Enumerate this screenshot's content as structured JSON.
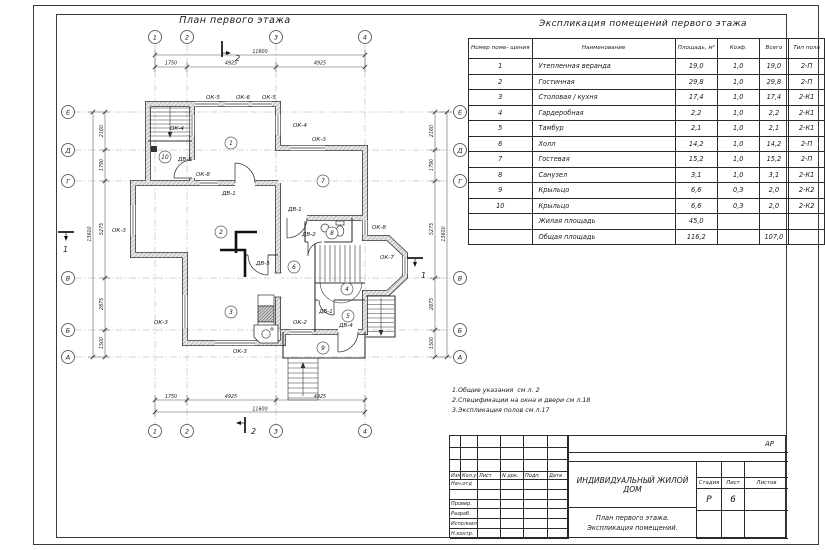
{
  "plan": {
    "title": "План первого этажа",
    "col_axes": [
      {
        "label": "1",
        "x": 105
      },
      {
        "label": "2",
        "x": 137
      },
      {
        "label": "3",
        "x": 226
      },
      {
        "label": "4",
        "x": 315
      }
    ],
    "row_axes": [
      {
        "label": "Е",
        "y": 102
      },
      {
        "label": "Д",
        "y": 140
      },
      {
        "label": "Г",
        "y": 171
      },
      {
        "label": "В",
        "y": 268
      },
      {
        "label": "Б",
        "y": 320
      },
      {
        "label": "А",
        "y": 347
      }
    ],
    "dims_top": [
      {
        "text": "1750",
        "x": 121
      },
      {
        "text": "4925",
        "x": 181
      },
      {
        "text": "4925",
        "x": 270
      }
    ],
    "dim_top_total": "11600",
    "dims_left": [
      {
        "text": "2160",
        "y": 121
      },
      {
        "text": "1790",
        "y": 155
      },
      {
        "text": "5275",
        "y": 219
      },
      {
        "text": "2875",
        "y": 294
      },
      {
        "text": "1500",
        "y": 333
      }
    ],
    "dim_left_total": "13600",
    "rooms": [
      {
        "n": "1",
        "x": 181,
        "y": 133
      },
      {
        "n": "2",
        "x": 171,
        "y": 222
      },
      {
        "n": "3",
        "x": 181,
        "y": 302
      },
      {
        "n": "4",
        "x": 297,
        "y": 279
      },
      {
        "n": "5",
        "x": 298,
        "y": 306
      },
      {
        "n": "6",
        "x": 244,
        "y": 257
      },
      {
        "n": "7",
        "x": 273,
        "y": 171
      },
      {
        "n": "8",
        "x": 282,
        "y": 223
      },
      {
        "n": "9",
        "x": 273,
        "y": 338
      },
      {
        "n": "10",
        "x": 115,
        "y": 147
      }
    ],
    "labels": [
      {
        "t": "ОК-5",
        "x": 156,
        "y": 89
      },
      {
        "t": "ОК-6",
        "x": 186,
        "y": 89
      },
      {
        "t": "ОК-5",
        "x": 212,
        "y": 89
      },
      {
        "t": "ОК-4",
        "x": 120,
        "y": 120
      },
      {
        "t": "ОК-4",
        "x": 243,
        "y": 117
      },
      {
        "t": "ОК-3",
        "x": 262,
        "y": 131
      },
      {
        "t": "ДВ-6",
        "x": 128,
        "y": 151
      },
      {
        "t": "ОК-8",
        "x": 146,
        "y": 166
      },
      {
        "t": "ДВ-1",
        "x": 172,
        "y": 185
      },
      {
        "t": "ОК-3",
        "x": 62,
        "y": 222
      },
      {
        "t": "ОК-3",
        "x": 104,
        "y": 314
      },
      {
        "t": "ОК-3",
        "x": 183,
        "y": 343
      },
      {
        "t": "ОК-2",
        "x": 243,
        "y": 314
      },
      {
        "t": "ДВ-5",
        "x": 206,
        "y": 255
      },
      {
        "t": "ДВ-1",
        "x": 238,
        "y": 201
      },
      {
        "t": "ДВ-2",
        "x": 252,
        "y": 226
      },
      {
        "t": "ОК-8",
        "x": 322,
        "y": 219
      },
      {
        "t": "ОК-7",
        "x": 330,
        "y": 249
      },
      {
        "t": "ДВ-1",
        "x": 269,
        "y": 303
      },
      {
        "t": "ДВ-4",
        "x": 289,
        "y": 317
      }
    ],
    "section_marks": [
      {
        "label": "2",
        "text_x": 185,
        "text_y": 51,
        "line": "M172,31 L172,47",
        "tick": "M172,43 L180,43",
        "arrow": "181,43 176,41 176,45"
      },
      {
        "label": "2",
        "text_x": 201,
        "text_y": 424,
        "line": "M195,407 L195,423",
        "tick": "M195,413 L187,413",
        "arrow": "186,413 191,411 191,415"
      },
      {
        "label": "1",
        "text_x": 13,
        "text_y": 242,
        "line": "M8,222 L24,222",
        "tick": "M16,222 L16,230",
        "arrow": "16,231 14,226 18,226"
      },
      {
        "label": "1",
        "text_x": 371,
        "text_y": 268,
        "line": "M357,248 L373,248",
        "tick": "M365,248 L365,256",
        "arrow": "365,257 363,252 367,252"
      }
    ]
  },
  "spec": {
    "title": "Экспликация помещений первого этажа",
    "headers": [
      "Номер поме- щения",
      "Наименование",
      "Площадь, м²",
      "Коэф.",
      "Всего",
      "Тип пола"
    ],
    "rows": [
      [
        "1",
        "Утепленная веранда",
        "19,0",
        "1,0",
        "19,0",
        "2-П"
      ],
      [
        "2",
        "Гостинная",
        "29,8",
        "1,0",
        "29,8",
        "2-П"
      ],
      [
        "3",
        "Столовая / кухня",
        "17,4",
        "1,0",
        "17,4",
        "2-К1"
      ],
      [
        "4",
        "Гардеробная",
        "2,2",
        "1,0",
        "2,2",
        "2-К1"
      ],
      [
        "5",
        "Тамбур",
        "2,1",
        "1,0",
        "2,1",
        "2-К1"
      ],
      [
        "6",
        "Холл",
        "14,2",
        "1,0",
        "14,2",
        "2-П"
      ],
      [
        "7",
        "Гостевая",
        "15,2",
        "1,0",
        "15,2",
        "2-П"
      ],
      [
        "8",
        "Санузел",
        "3,1",
        "1,0",
        "3,1",
        "2-К1"
      ],
      [
        "9",
        "Крыльцо",
        "6,6",
        "0,3",
        "2,0",
        "2-К2"
      ],
      [
        "10",
        "Крыльцо",
        "6,6",
        "0,3",
        "2,0",
        "2-К2"
      ],
      [
        "",
        "Жилая площадь",
        "45,0",
        "",
        "",
        ""
      ],
      [
        "",
        "Общая площадь",
        "116,2",
        "",
        "107,0",
        ""
      ]
    ]
  },
  "notes": [
    "1.Общие указания  см л. 2",
    "2.Спецификации на окна и двери см л.18",
    "3.Экспликация полов см л.17"
  ],
  "titleblock": {
    "code": "АР",
    "header_cols": [
      "Изм.",
      "Кол.уч",
      "Лист",
      "N док.",
      "Подп.",
      "Дата"
    ],
    "staff_rows": [
      "Нач.отд",
      "",
      "Провер.",
      "Разраб.",
      "Исполнил",
      "Н.контр."
    ],
    "doc_title": "ИНДИВИДУАЛЬНЫЙ ЖИЛОЙ ДОМ",
    "sheet_title_lines": [
      "План первого этажа.",
      "Экспликация помещений."
    ],
    "stage_label": "Стадия",
    "sheet_label": "Лист",
    "sheets_label": "Листов",
    "stage": "Р",
    "sheet_no": "6",
    "sheets": ""
  }
}
